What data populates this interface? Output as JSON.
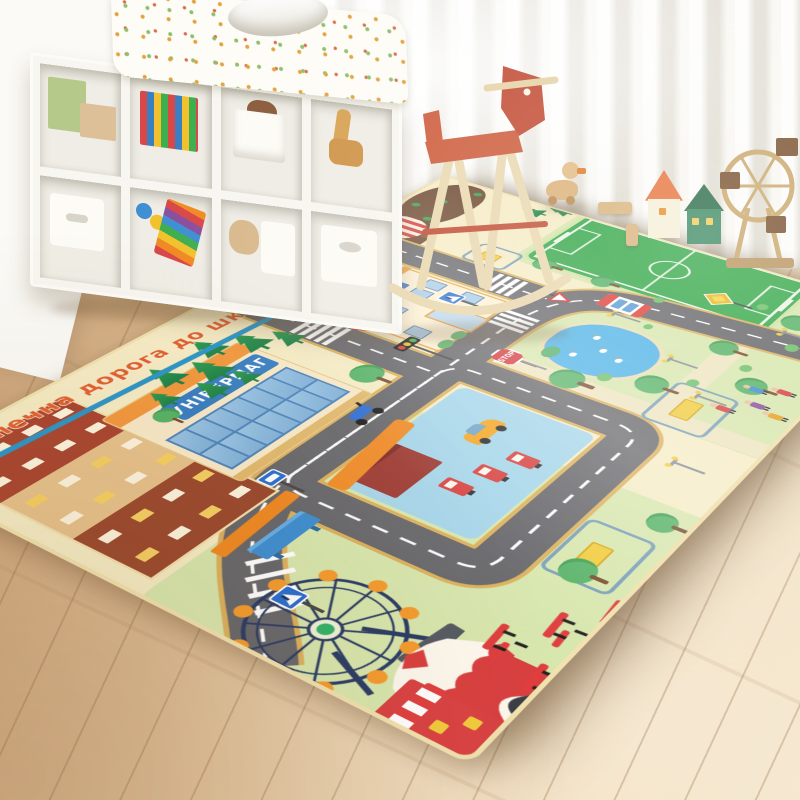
{
  "scene": {
    "kind": "product-photo",
    "setting": "kids-playroom",
    "subject": "city-road-play-mat-rug"
  },
  "room": {
    "floor": {
      "material": "light-oak-planks",
      "color": "#ddbb92"
    },
    "curtain": {
      "style": "sheer-white"
    },
    "shelf": {
      "color": "#f8f6f0",
      "items": [
        "green-book",
        "beige-box",
        "picture-books",
        "storage-box-white",
        "teddy-bear",
        "wooden-giraffe",
        "drawer-box",
        "toy-balls",
        "xylophone-rainbow",
        "storage-bin-white"
      ]
    },
    "toys": [
      "rocking-horse-red-seat",
      "wooden-duck",
      "toy-house-orange-roof",
      "toy-house-green",
      "wooden-ferris-wheel-toy",
      "wooden-blocks"
    ],
    "quilt": {
      "pattern": "floral-dots"
    }
  },
  "mat": {
    "title": "Безпечна дорога до школи",
    "title_color": "#e2622f",
    "underline_color": "#2e96c8",
    "store_sign": "УНІВЕРМАГ",
    "stop_sign": "STOP",
    "base_color": "#f6ecc5",
    "road_color": "#68686c",
    "grass_color": "#d8e7ae",
    "pond_color": "#4fb3e8",
    "field_color": "#38a94c",
    "features": [
      "apartment-buildings",
      "department-store",
      "school-with-clock",
      "soccer-field",
      "hot-air-balloon",
      "mountains",
      "gas-station",
      "central-road-loop",
      "pond-with-ducks",
      "ferris-wheel",
      "circus-tent",
      "kiosk-shop",
      "bus-shelter",
      "bus-stop-sign",
      "traffic-light",
      "stop-sign",
      "pedestrian-signs",
      "yield-signs",
      "priority-diamond-sign",
      "crosswalks",
      "bus",
      "scooter",
      "yellow-car",
      "park-benches",
      "playground-frames",
      "lamp-posts",
      "people",
      "pine-trees",
      "round-trees"
    ],
    "mountains": [
      {
        "x": 555,
        "y": 8,
        "w": 150,
        "h": 92
      },
      {
        "x": 690,
        "y": 0,
        "w": 150,
        "h": 105
      },
      {
        "x": 825,
        "y": 5,
        "w": 160,
        "h": 90
      },
      {
        "x": 615,
        "y": 55,
        "w": 80,
        "h": 58
      }
    ],
    "mnt_trees": [
      {
        "x": 620,
        "y": 38
      },
      {
        "x": 700,
        "y": 52
      },
      {
        "x": 762,
        "y": 28
      },
      {
        "x": 842,
        "y": 58
      },
      {
        "x": 905,
        "y": 42
      },
      {
        "x": 958,
        "y": 66
      },
      {
        "x": 872,
        "y": 18
      }
    ],
    "pines": [
      {
        "x": 285,
        "y": 58,
        "s": 40
      },
      {
        "x": 325,
        "y": 84,
        "s": 44
      },
      {
        "x": 365,
        "y": 52,
        "s": 38
      },
      {
        "x": 405,
        "y": 78,
        "s": 42
      },
      {
        "x": 443,
        "y": 108,
        "s": 36
      },
      {
        "x": 298,
        "y": 120,
        "s": 34
      },
      {
        "x": 345,
        "y": 133,
        "s": 30
      },
      {
        "x": 252,
        "y": 96,
        "s": 30
      },
      {
        "x": 948,
        "y": 148,
        "s": 30
      },
      {
        "x": 975,
        "y": 178,
        "s": 28
      }
    ],
    "round_trees": [
      {
        "x": 428,
        "y": 238,
        "s": 42
      },
      {
        "x": 508,
        "y": 96,
        "s": 34
      },
      {
        "x": 228,
        "y": 128,
        "s": 30
      },
      {
        "x": 558,
        "y": 424,
        "s": 44
      },
      {
        "x": 608,
        "y": 508,
        "s": 42
      },
      {
        "x": 676,
        "y": 602,
        "s": 40
      },
      {
        "x": 742,
        "y": 538,
        "s": 38
      },
      {
        "x": 856,
        "y": 580,
        "s": 42
      },
      {
        "x": 930,
        "y": 634,
        "s": 36
      },
      {
        "x": 808,
        "y": 252,
        "s": 34
      },
      {
        "x": 812,
        "y": 338,
        "s": 32
      },
      {
        "x": 250,
        "y": 618,
        "s": 40
      },
      {
        "x": 372,
        "y": 648,
        "s": 34
      }
    ],
    "bushes": [
      {
        "x": 600,
        "y": 468,
        "s": 20
      },
      {
        "x": 652,
        "y": 556,
        "s": 18
      },
      {
        "x": 722,
        "y": 590,
        "s": 18
      },
      {
        "x": 802,
        "y": 612,
        "s": 20
      },
      {
        "x": 882,
        "y": 540,
        "s": 18
      },
      {
        "x": 952,
        "y": 608,
        "s": 20
      },
      {
        "x": 818,
        "y": 428,
        "s": 16
      },
      {
        "x": 746,
        "y": 452,
        "s": 14
      },
      {
        "x": 530,
        "y": 160,
        "s": 16
      },
      {
        "x": 600,
        "y": 120,
        "s": 14
      }
    ],
    "lamps": [
      {
        "x": 756,
        "y": 408
      },
      {
        "x": 694,
        "y": 516
      },
      {
        "x": 636,
        "y": 580
      },
      {
        "x": 842,
        "y": 596
      },
      {
        "x": 494,
        "y": 622
      },
      {
        "x": 902,
        "y": 644
      },
      {
        "x": 582,
        "y": 378
      }
    ],
    "people": [
      {
        "x": 624,
        "y": 608,
        "c": "#d94040"
      },
      {
        "x": 654,
        "y": 636,
        "c": "#8a4f9e"
      },
      {
        "x": 686,
        "y": 620,
        "c": "#3f8fd2"
      },
      {
        "x": 644,
        "y": 662,
        "c": "#e8a020"
      },
      {
        "x": 700,
        "y": 648,
        "c": "#d94040"
      }
    ],
    "benches": [
      {
        "x": 122,
        "y": 622
      },
      {
        "x": 168,
        "y": 656
      },
      {
        "x": 214,
        "y": 688
      },
      {
        "x": 96,
        "y": 678
      }
    ],
    "ducks": [
      {
        "x": 28,
        "y": 38
      },
      {
        "x": 58,
        "y": 62
      },
      {
        "x": 82,
        "y": 40
      },
      {
        "x": 48,
        "y": 88
      }
    ]
  }
}
